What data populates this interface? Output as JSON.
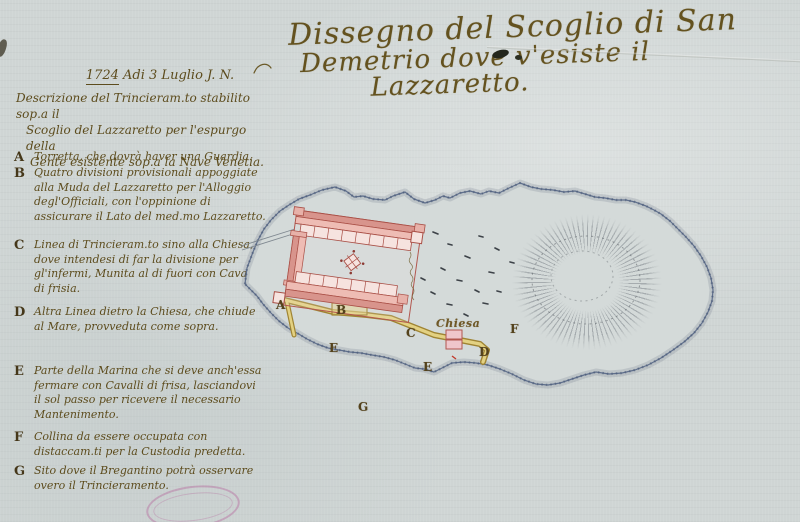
{
  "page": {
    "title_lines": [
      "Dissegno del Scoglio di San",
      "Demetrio dove v'esiste il",
      "Lazzaretto."
    ],
    "date": {
      "year": "1724",
      "rest": "Adi 3 Luglio J. N."
    },
    "description_lines": [
      "Descrizione del Trincieram.to stabilito sop.a il",
      "Scoglio del Lazzaretto per l'espurgo della",
      "Gente esistente sop.a la Nave Venetia."
    ]
  },
  "legend": {
    "items": [
      {
        "letter": "A",
        "text": "Torretta, che dovrà haver una Guardia."
      },
      {
        "letter": "B",
        "text": "Quatro divisioni provisionali appoggiate alla Muda del Lazzaretto per l'Alloggio degl'Officiali, con l'oppinione di assicurare il Lato del med.mo Lazzaretto."
      },
      {
        "letter": "C",
        "text": "Linea di Trincieram.to sino alla Chiesa, dove intendesi di far la divisione per gl'infermi, Munita al di fuori con Cavalli di frisia."
      },
      {
        "letter": "D",
        "text": "Altra Linea dietro la Chiesa, che chiude al Mare, provveduta come sopra."
      },
      {
        "letter": "E",
        "text": "Parte della Marina che si deve anch'essa fermare con Cavalli di frisa, lasciandovi il sol passo per ricevere il necessario Mantenimento."
      },
      {
        "letter": "F",
        "text": "Collina da essere occupata con distaccam.ti per la Custodia predetta."
      },
      {
        "letter": "G",
        "text": "Sito dove il Bregantino potrà osservare overo il Trincieramento."
      }
    ]
  },
  "map": {
    "labels": {
      "a": "A",
      "b": "B",
      "c": "C",
      "d": "D",
      "e1": "E",
      "e2": "E",
      "f": "F",
      "g": "G",
      "chiesa": "Chiesa"
    }
  },
  "colors": {
    "paper": "#cfd5d4",
    "ink": "#5d4c1d",
    "island_outline": "#5f6f8c",
    "fort_fill": "#e7b1a9",
    "fort_outline": "#a94f46",
    "trench": "#e3d182",
    "trench_edge": "#9f8433",
    "stamp": "#b25a96"
  }
}
